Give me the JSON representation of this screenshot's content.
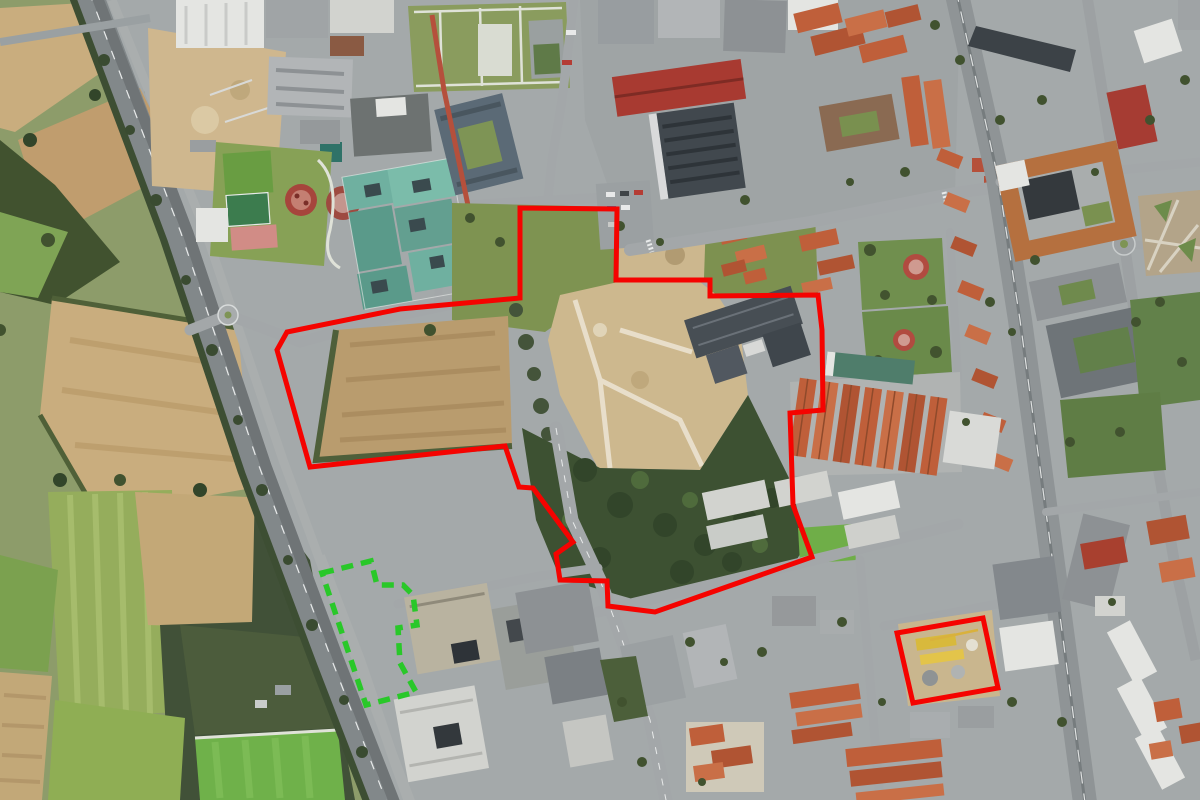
{
  "app": {
    "title": "Aerial satellite view with annotated site boundaries"
  },
  "map": {
    "view_type": "satellite-aerial-oblique",
    "annotations": [
      {
        "id": "red-boundary-main-site",
        "type": "polygon",
        "line_style": "solid",
        "stroke": "#f50300",
        "stroke_width": 5,
        "points": [
          [
            520,
            208
          ],
          [
            617,
            209
          ],
          [
            616,
            280
          ],
          [
            710,
            280
          ],
          [
            710,
            296
          ],
          [
            818,
            295
          ],
          [
            822,
            330
          ],
          [
            823,
            410
          ],
          [
            790,
            413
          ],
          [
            793,
            505
          ],
          [
            812,
            557
          ],
          [
            655,
            612
          ],
          [
            608,
            606
          ],
          [
            607,
            581
          ],
          [
            560,
            580
          ],
          [
            556,
            554
          ],
          [
            573,
            542
          ],
          [
            533,
            488
          ],
          [
            519,
            487
          ],
          [
            505,
            446
          ],
          [
            310,
            467
          ],
          [
            277,
            350
          ],
          [
            287,
            332
          ],
          [
            400,
            309
          ],
          [
            520,
            298
          ]
        ]
      },
      {
        "id": "red-boundary-secondary-block",
        "type": "polygon",
        "line_style": "solid",
        "stroke": "#f50300",
        "stroke_width": 5,
        "points": [
          [
            897,
            633
          ],
          [
            983,
            618
          ],
          [
            998,
            688
          ],
          [
            913,
            703
          ]
        ]
      },
      {
        "id": "green-dashed-boundary-highway-strip",
        "type": "polygon",
        "line_style": "dashed",
        "stroke": "#29c829",
        "stroke_width": 5.5,
        "dash_pattern": [
          12,
          8
        ],
        "points": [
          [
            322,
            573
          ],
          [
            371,
            561
          ],
          [
            377,
            585
          ],
          [
            403,
            585
          ],
          [
            413,
            595
          ],
          [
            417,
            625
          ],
          [
            398,
            628
          ],
          [
            400,
            663
          ],
          [
            416,
            692
          ],
          [
            366,
            705
          ]
        ]
      }
    ],
    "palette": {
      "boundary_red": "#f50300",
      "boundary_green": "#29c829",
      "farm_field_tan": "#c9ad7e",
      "meadow_green": "#8d9c6a",
      "forest_green": "#41522f",
      "road_gray": "#8f9496",
      "roof_terracotta": "#bf5f3a",
      "roof_teal": "#6fb0a0",
      "construction_dirt": "#cdb88e"
    }
  }
}
